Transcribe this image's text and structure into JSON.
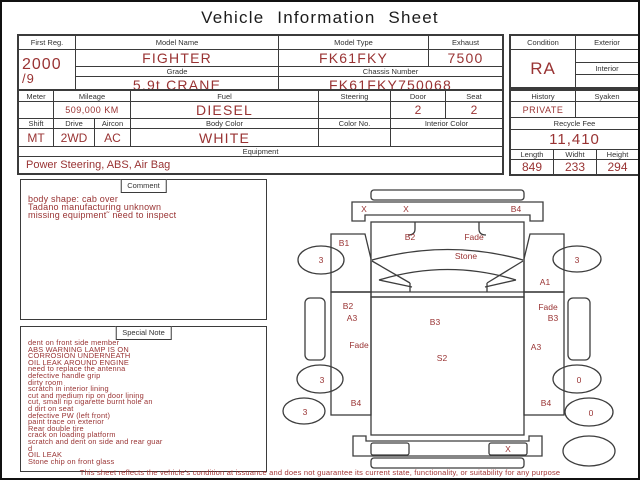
{
  "title": "Vehicle Information Sheet",
  "colors": {
    "value_red": "#993333",
    "line": "#3d3d3d",
    "footer_red": "#a23434"
  },
  "table1": {
    "first_reg_label": "First Reg.",
    "first_reg_line1": "2000",
    "first_reg_line2": "/9",
    "model_name_label": "Model Name",
    "model_name": "FIGHTER",
    "model_type_label": "Model Type",
    "model_type": "FK61FKY",
    "exhaust_label": "Exhaust",
    "exhaust": "7500",
    "grade_label": "Grade",
    "grade": "5.9t CRANE",
    "chassis_label": "Chassis Number",
    "chassis": "FK61FKY750068"
  },
  "condition_panel": {
    "condition_label": "Condition",
    "condition": "RA",
    "exterior_label": "Exterior",
    "exterior": "",
    "interior_label": "Interior",
    "interior": ""
  },
  "table2": {
    "meter_label": "Meter",
    "meter": "",
    "mileage_label": "Mileage",
    "mileage": "509,000 KM",
    "fuel_label": "Fuel",
    "fuel": "DIESEL",
    "steering_label": "Steering",
    "steering": "",
    "door_label": "Door",
    "door": "2",
    "seat_label": "Seat",
    "seat": "2",
    "shift_label": "Shift",
    "shift": "MT",
    "drive_label": "Drive",
    "drive": "2WD",
    "aircon_label": "Aircon",
    "aircon": "AC",
    "body_color_label": "Body Color",
    "body_color": "WHITE",
    "color_no_label": "Color No.",
    "color_no": "",
    "interior_color_label": "Interior Color",
    "interior_color": "",
    "equipment_label": "Equipment",
    "equipment": "Power Steering, ABS, Air Bag"
  },
  "history_panel": {
    "history_label": "History",
    "history": "PRIVATE",
    "syaken_label": "Syaken",
    "syaken": "",
    "recycle_label": "Recycle Fee",
    "recycle_fee": "11,410",
    "length_label": "Length",
    "length": "849",
    "width_label": "Widht",
    "width": "233",
    "height_label": "Height",
    "height": "294"
  },
  "comment": {
    "label": "Comment",
    "text": "body shape: cab over\nTadano manufacturing unknown\nmissing equipment˜ need to inspect"
  },
  "special_note": {
    "label": "Special Note",
    "text": "dent on front side member\nABS WARNING LAMP IS ON\nCORROSION UNDERNEATH\nOIL LEAK AROUND ENGINE\nneed to replace the antenna\ndefective handle grip\ndirty room\nscratch in interior lining\ncut and medium rip on door lining\ncut, small rip cigarette burnt hole an\nd dirt on seat\ndefective PW (left front)\npaint trace on exterior\nRear double tire\ncrack on loading platform\nscratch and dent on side and rear guar\nd\nOIL LEAK\nStone chip on front glass"
  },
  "footer": "This sheet reflects the vehicle's condition at issuance and does not guarantee its current state, functionality, or suitability for any purpose",
  "diagram": {
    "labels": [
      {
        "t": "X",
        "x": 82,
        "y": 30
      },
      {
        "t": "X",
        "x": 124,
        "y": 30
      },
      {
        "t": "B4",
        "x": 234,
        "y": 30
      },
      {
        "t": "B1",
        "x": 62,
        "y": 64
      },
      {
        "t": "B2",
        "x": 128,
        "y": 58
      },
      {
        "t": "Fade",
        "x": 192,
        "y": 58
      },
      {
        "t": "Stone",
        "x": 184,
        "y": 77
      },
      {
        "t": "A1",
        "x": 263,
        "y": 103
      },
      {
        "t": "3",
        "x": 39,
        "y": 81
      },
      {
        "t": "3",
        "x": 295,
        "y": 81
      },
      {
        "t": "B2",
        "x": 66,
        "y": 127
      },
      {
        "t": "A3",
        "x": 70,
        "y": 139
      },
      {
        "t": "Fade",
        "x": 77,
        "y": 166
      },
      {
        "t": "B4",
        "x": 74,
        "y": 224
      },
      {
        "t": "Fade",
        "x": 266,
        "y": 128
      },
      {
        "t": "B3",
        "x": 271,
        "y": 139
      },
      {
        "t": "A3",
        "x": 254,
        "y": 168
      },
      {
        "t": "B4",
        "x": 264,
        "y": 224
      },
      {
        "t": "B3",
        "x": 153,
        "y": 143
      },
      {
        "t": "S2",
        "x": 160,
        "y": 179
      },
      {
        "t": "3",
        "x": 40,
        "y": 201
      },
      {
        "t": "3",
        "x": 23,
        "y": 233
      },
      {
        "t": "0",
        "x": 297,
        "y": 201
      },
      {
        "t": "0",
        "x": 309,
        "y": 234
      },
      {
        "t": "X",
        "x": 226,
        "y": 270
      }
    ]
  }
}
